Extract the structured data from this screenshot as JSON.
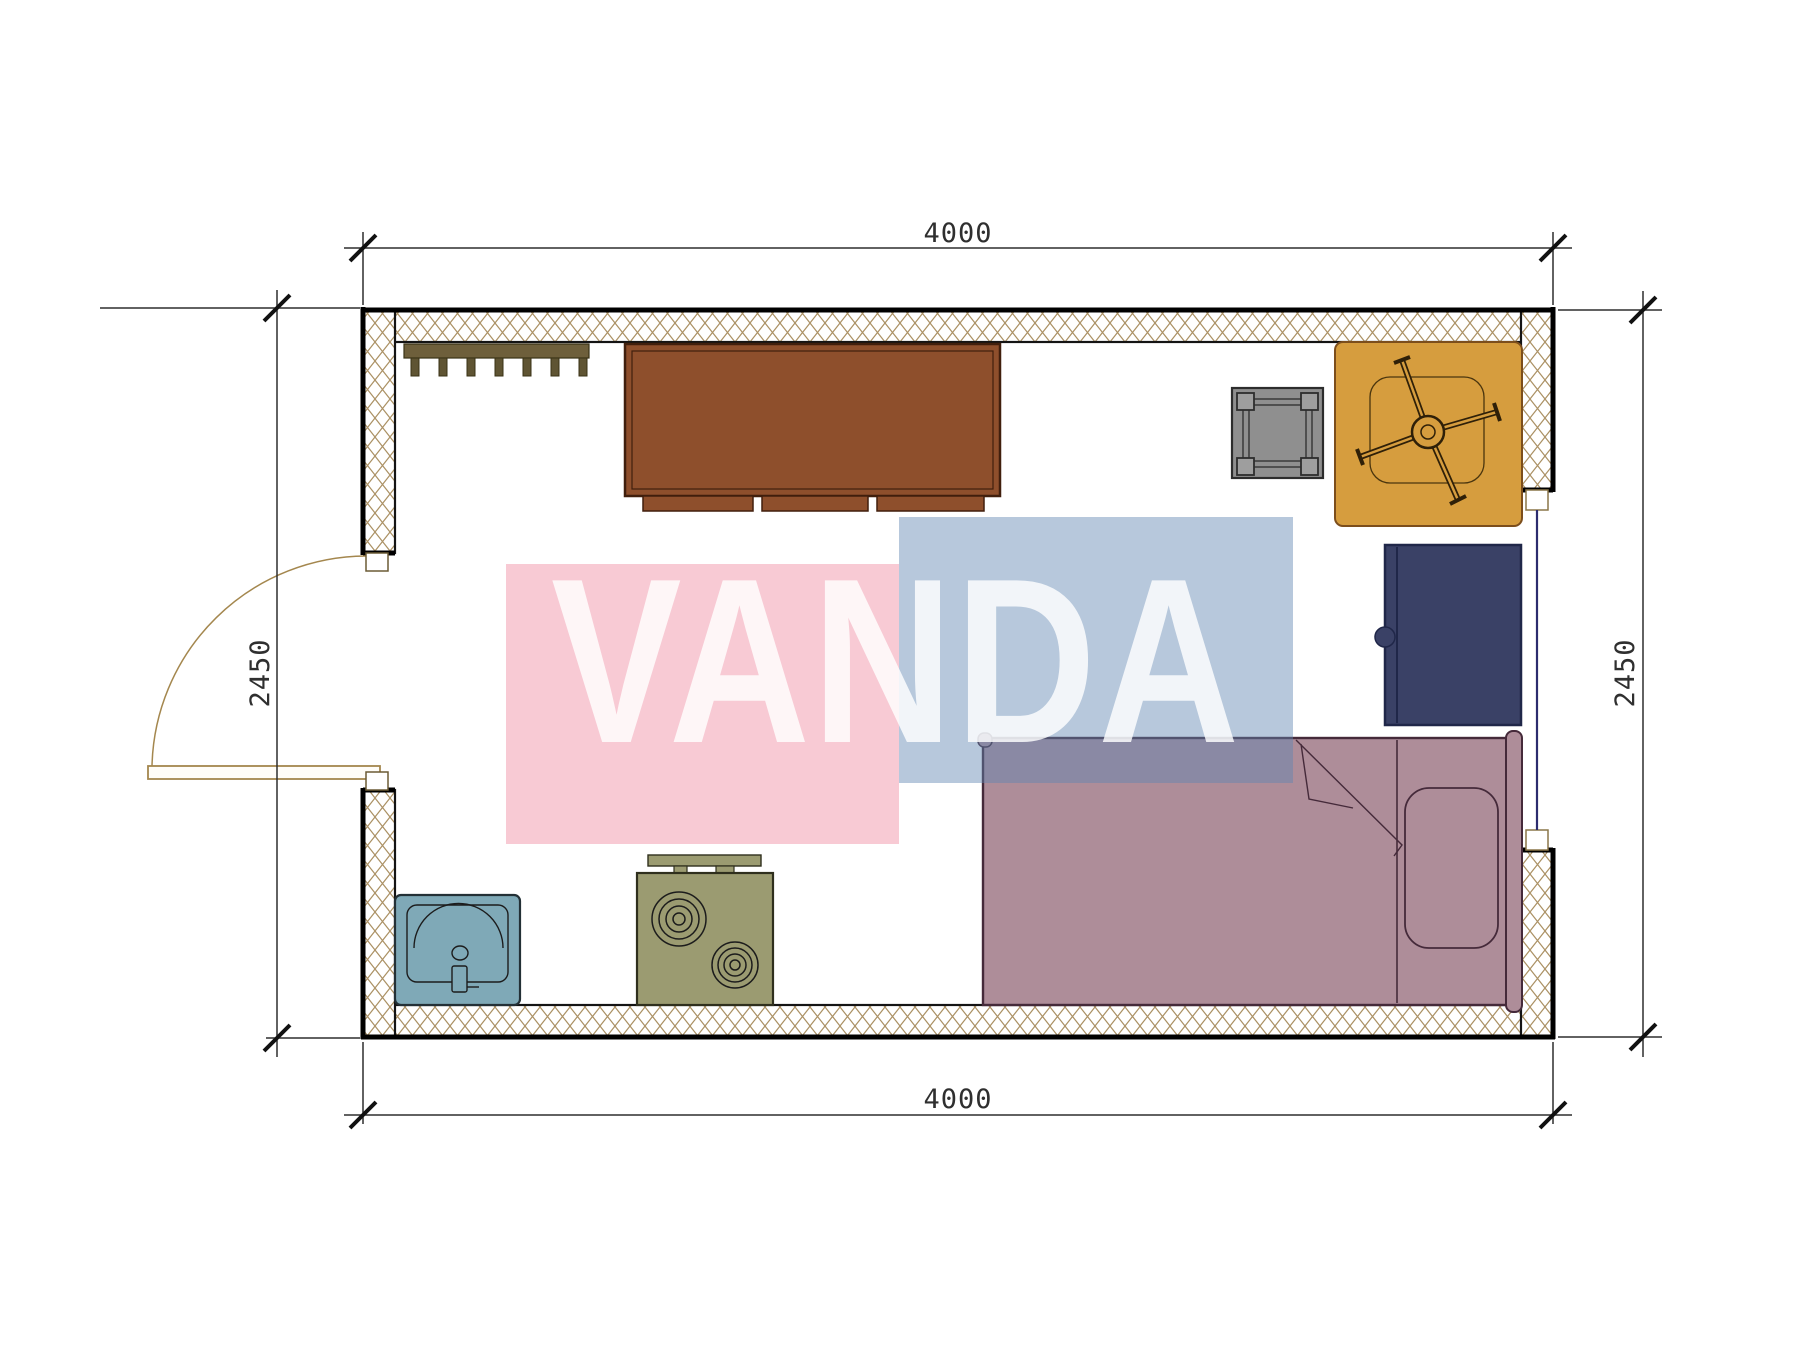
{
  "drawing": {
    "type": "floor-plan",
    "watermark": {
      "text": "VANDA",
      "pink_color": "#f8cad4",
      "blue_color": "#5f85b2",
      "text_color": "#ffffff"
    },
    "dimensions": {
      "top": "4000",
      "bottom": "4000",
      "left": "2450",
      "right": "2450"
    },
    "room": {
      "width_mm": 4000,
      "depth_mm": 2450,
      "openings": [
        "entry-door-left",
        "window-right"
      ],
      "furniture": [
        "coat-rack",
        "cabinet",
        "stool",
        "office-chair-on-mat",
        "navy-cabinet",
        "single-bed",
        "washbasin",
        "two-burner-stove"
      ]
    },
    "colors": {
      "wall_hatch": "#ab9164",
      "wall_line": "#0d0d0d",
      "cabinet_brown": "#8e4f2c",
      "coat_rack": "#6e5f3b",
      "stool_gray": "#8f8f8f",
      "chair_mat_orange": "#d69d3e",
      "navy_cabinet": "#3a4166",
      "bed_mauve": "#ae8d99",
      "sink_teal": "#7fa9b7",
      "stove_olive": "#9b9b71",
      "door_swing": "#a4874e",
      "window_pane": "#2c2c6e",
      "dimension_line": "#2e2e2e"
    }
  }
}
